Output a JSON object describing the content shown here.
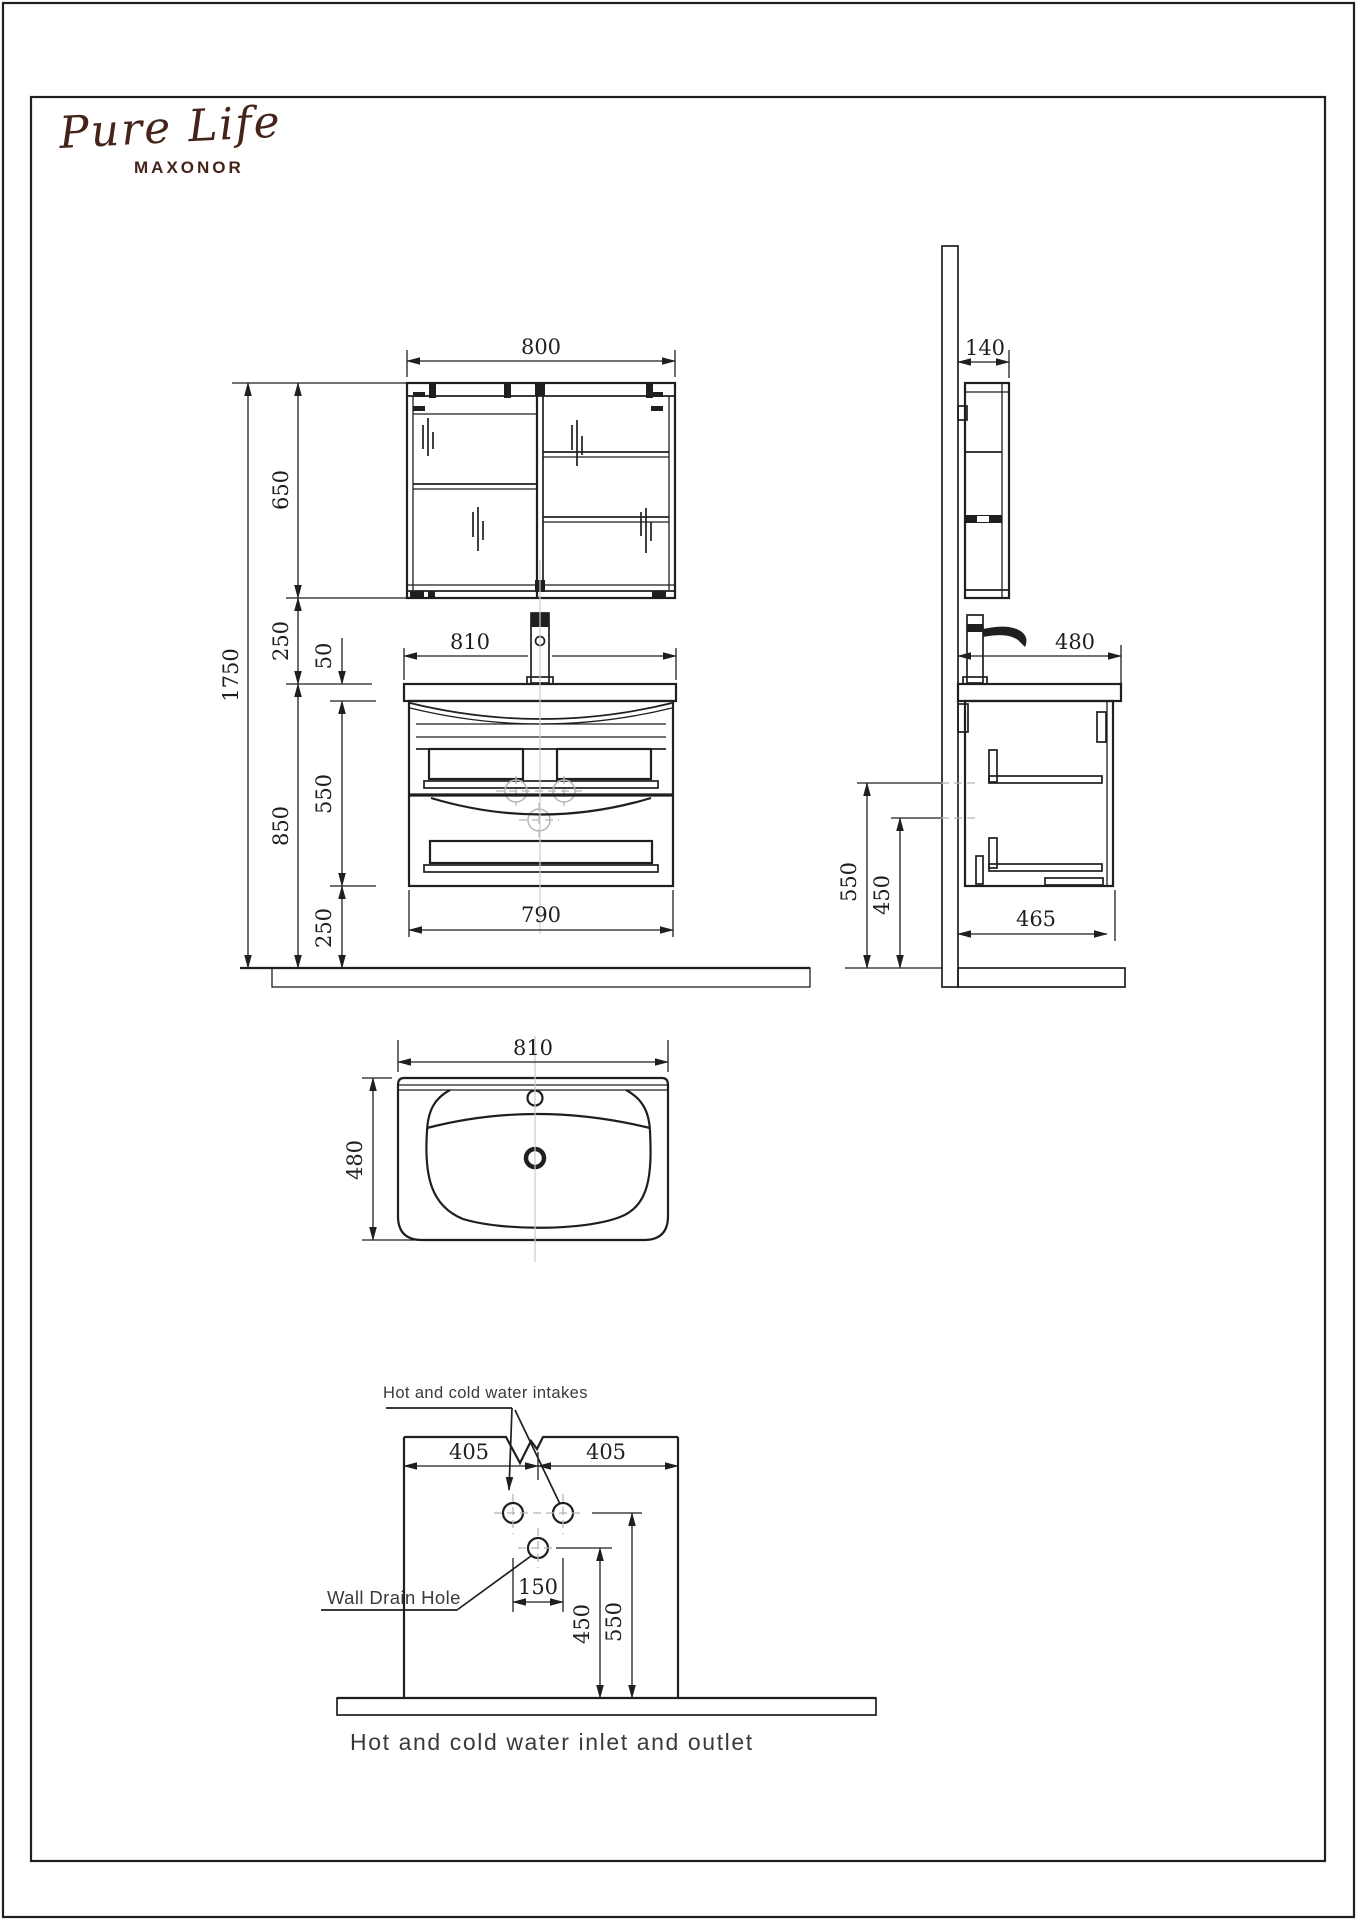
{
  "colors": {
    "line": "#1f1f1f",
    "phantom": "#b5b5b5",
    "label": "#3a3a3a",
    "brand": "#44231b",
    "paper": "#ffffff"
  },
  "brand": {
    "script": "Pure Life",
    "name": "MAXONOR"
  },
  "front_view": {
    "mirror_width": "800",
    "mirror_height": "650",
    "overall_height": "1750",
    "mirror_to_counter_gap": "250",
    "counter_thickness": "50",
    "counter_width": "810",
    "cabinet_height": "550",
    "cabinet_wall_zone": "850",
    "floor_clearance": "250",
    "cabinet_width": "790"
  },
  "side_view": {
    "mirror_depth": "140",
    "counter_depth": "480",
    "cabinet_depth": "465",
    "upper_ref_height": "550",
    "lower_ref_height": "450"
  },
  "plan_view": {
    "basin_width": "810",
    "basin_depth": "480"
  },
  "inlet_diagram": {
    "intakes_label": "Hot and cold water intakes",
    "drain_label": "Wall Drain Hole",
    "left_offset": "405",
    "right_offset": "405",
    "intake_spacing": "150",
    "drain_height": "450",
    "intake_height": "550",
    "caption": "Hot and cold water inlet and outlet"
  }
}
